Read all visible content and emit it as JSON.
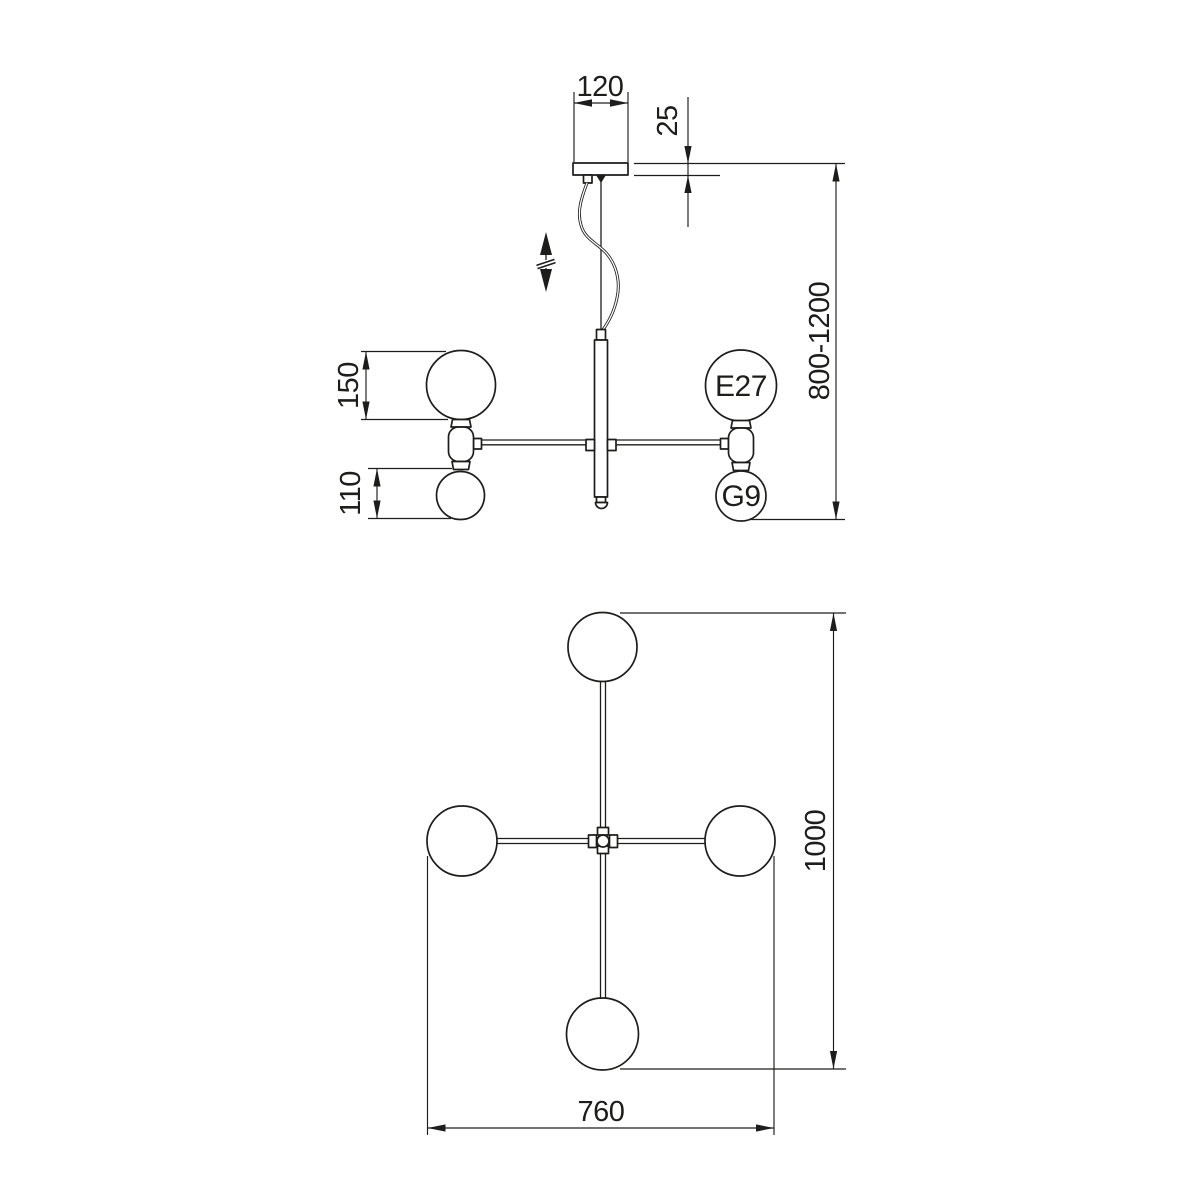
{
  "colors": {
    "line": "#1d1d1b",
    "background": "#ffffff"
  },
  "side_view": {
    "dim_canopy_width": "120",
    "dim_canopy_thickness": "25",
    "dim_hanging_height_range": "800-1200",
    "dim_large_globe_diameter": "150",
    "dim_small_globe_diameter": "110",
    "socket_large": "E27",
    "socket_small": "G9"
  },
  "plan_view": {
    "dim_overall_length": "1000",
    "dim_overall_width": "760"
  }
}
